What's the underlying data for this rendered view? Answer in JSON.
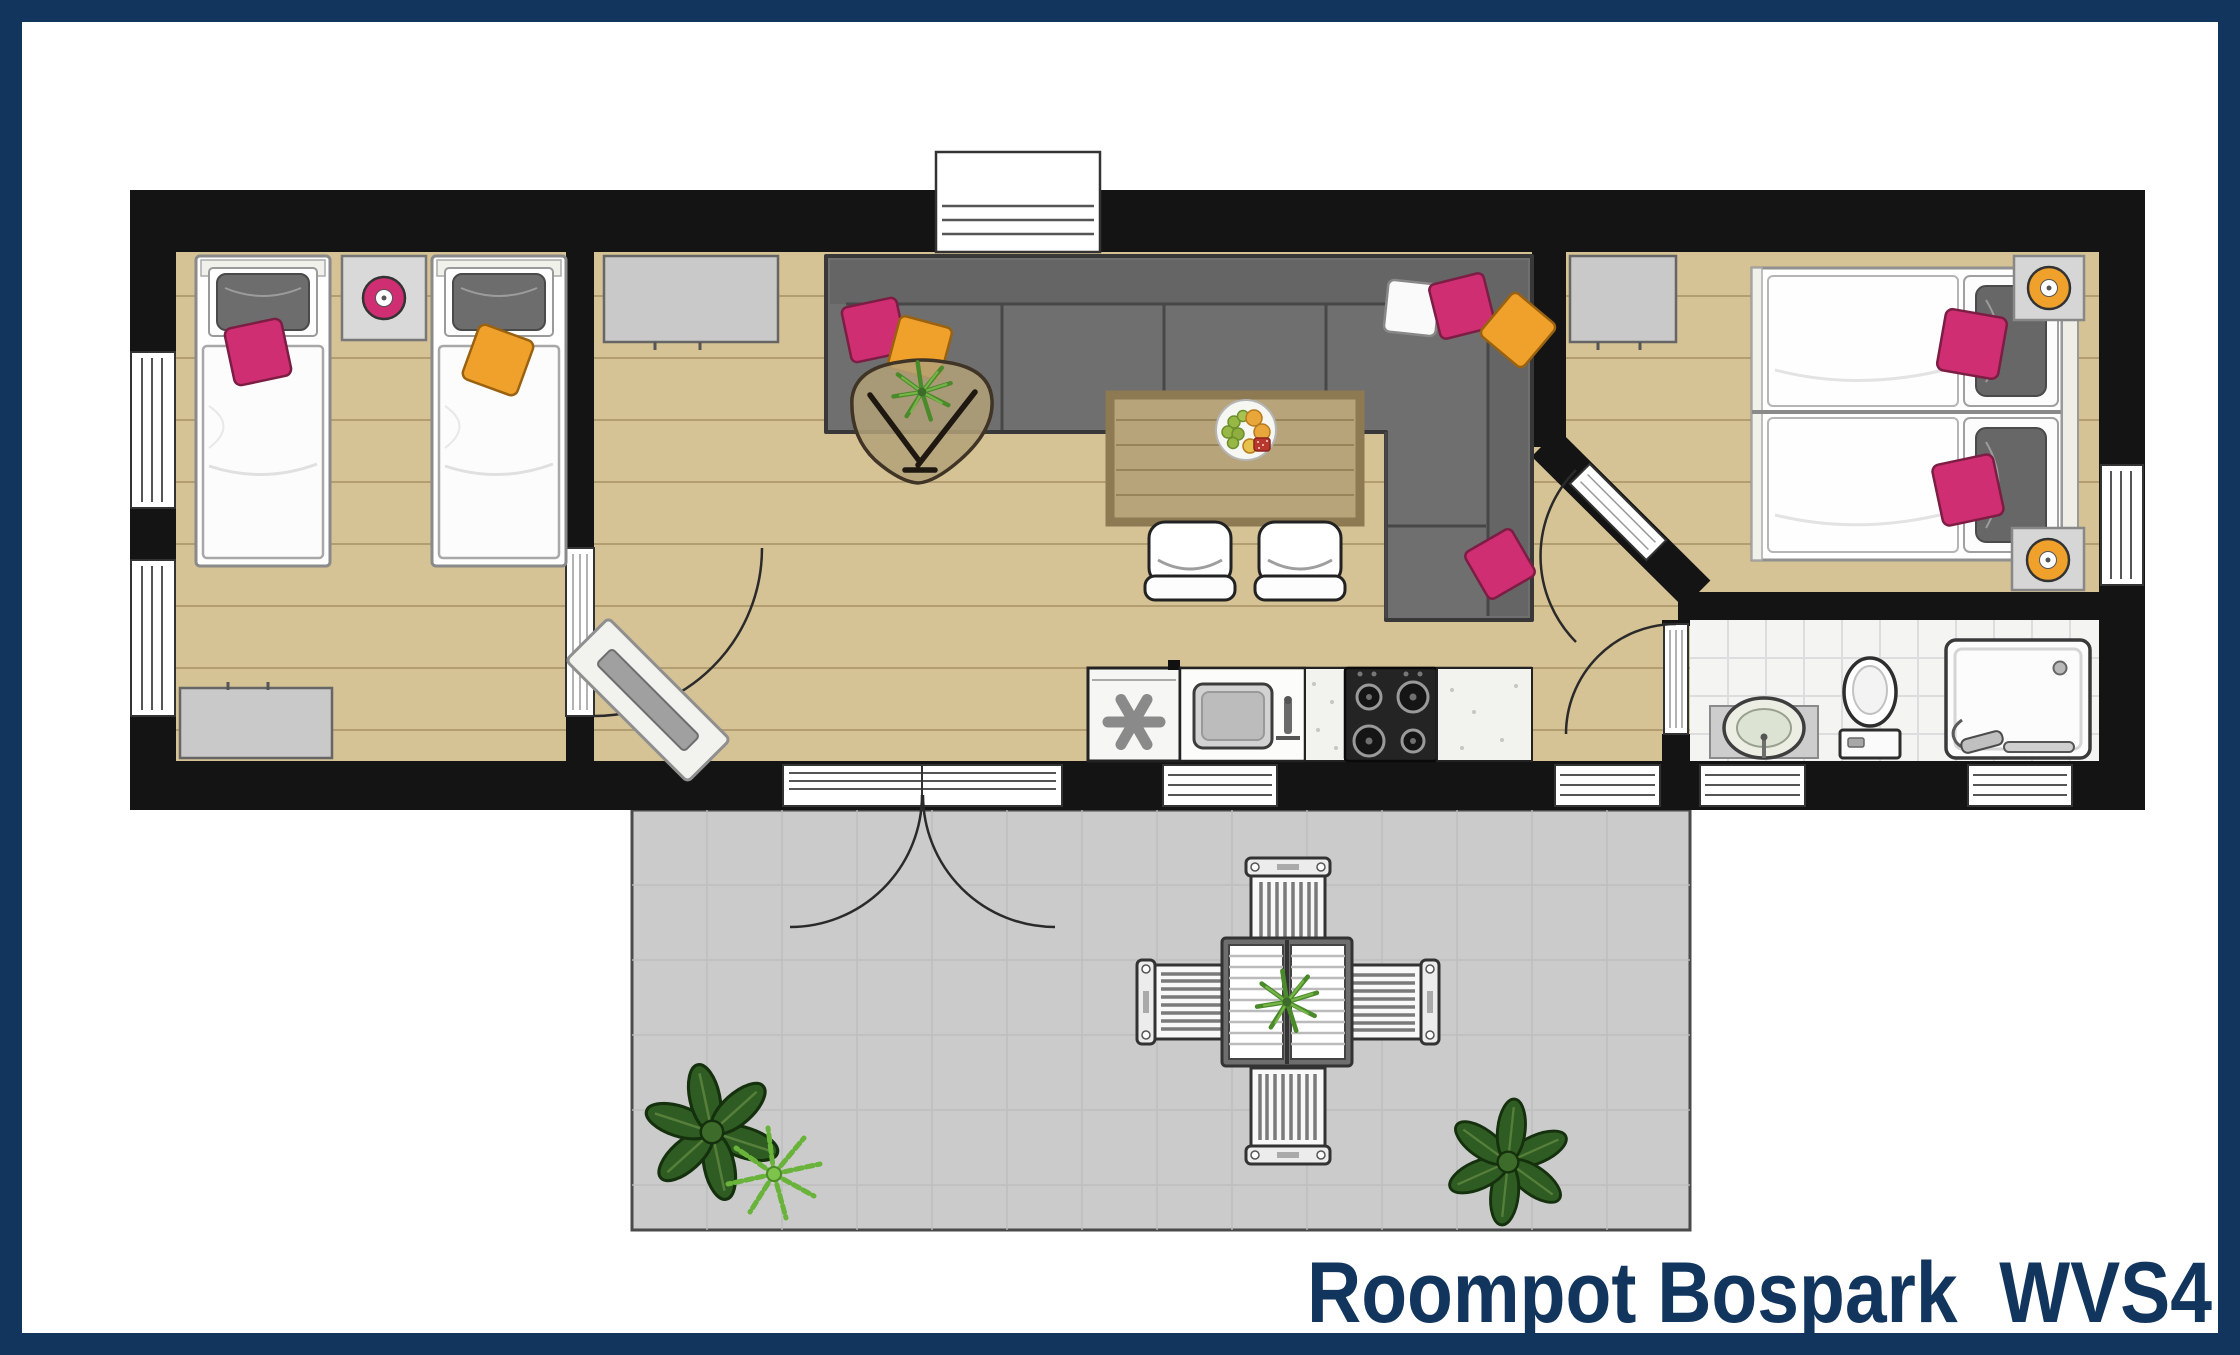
{
  "title": {
    "text": "Roompot Bospark  WVS4"
  },
  "theme": {
    "navy": "#12355e",
    "paper": "#ffffff",
    "wall": "#141414",
    "wood": "#d5c295",
    "plank": "#8a7448",
    "terrace": "#cbcbcb",
    "tile": "#f4f4f3",
    "pink": "#cf2f72",
    "orange": "#efa12b",
    "sofa": "#6f6f6f",
    "gray-furniture": "#c9c9c9",
    "leaf": "#2f5c22"
  },
  "floorplan": {
    "type": "holiday-home-top-view",
    "rooms": [
      {
        "name": "bedroom-left",
        "furniture": [
          "single-bed-pink-cushion",
          "single-bed-orange-cushion",
          "nightstand",
          "pink-table-lamp",
          "cabinet",
          "window",
          "window"
        ]
      },
      {
        "name": "living-room",
        "furniture": [
          "corner-sofa",
          "sofa-cushions",
          "coffee-table-with-plant",
          "dining-table-with-fruit-bowl",
          "dining-chair",
          "dining-chair",
          "sideboard",
          "radiator",
          "window-top"
        ]
      },
      {
        "name": "kitchen",
        "furniture": [
          "dishwasher",
          "sink-unit",
          "gas-hob",
          "worktop"
        ]
      },
      {
        "name": "bedroom-right",
        "furniture": [
          "double-bed-pink-cushions",
          "wardrobe",
          "nightstand",
          "orange-table-lamp",
          "orange-table-lamp",
          "window"
        ]
      },
      {
        "name": "bathroom",
        "furniture": [
          "washbasin",
          "toilet",
          "shower"
        ]
      },
      {
        "name": "terrace",
        "furniture": [
          "outdoor-table-with-plant",
          "outdoor-chair",
          "outdoor-chair",
          "outdoor-chair",
          "outdoor-chair",
          "plant-group",
          "plant"
        ]
      }
    ],
    "doors": [
      "bedroom-left-door",
      "french-doors-to-terrace",
      "bedroom-right-diagonal-door",
      "bathroom-door"
    ]
  }
}
